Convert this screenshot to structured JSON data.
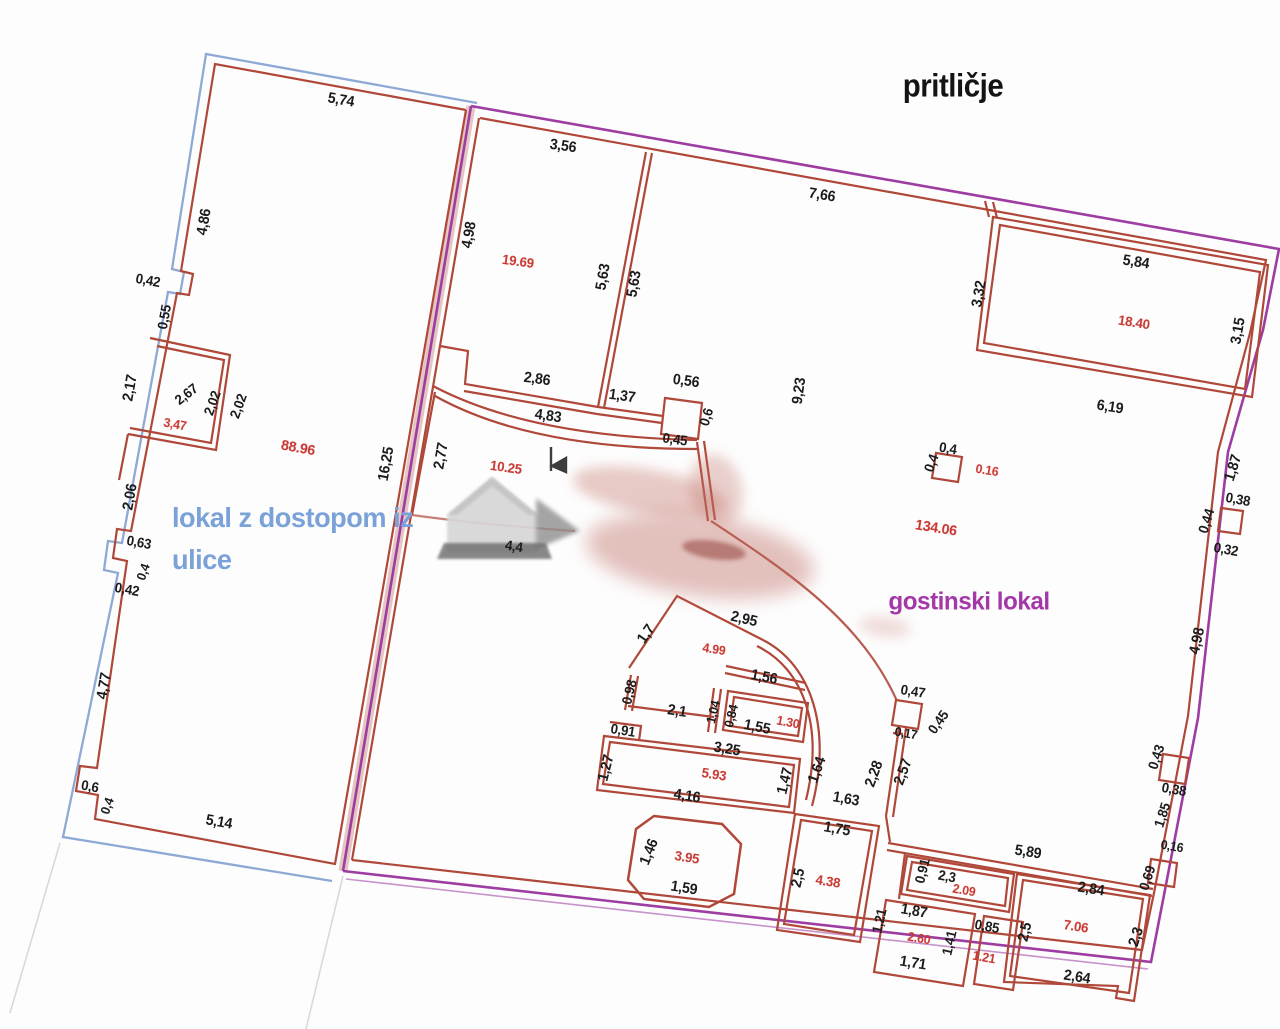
{
  "title": "pritličje",
  "units": {
    "left": {
      "name_line1": "lokal z dostopom iz",
      "name_line2": "ulice"
    },
    "right": {
      "name": "gostinski lokal"
    }
  },
  "colors": {
    "wall": "#b0483a",
    "area": "#c8352e",
    "dim": "#1c1c1c",
    "blue": "#8da9d4",
    "blueText": "#7aa2d8",
    "purple": "#9d3da2",
    "purpleText": "#a438a8"
  },
  "labels": [
    {
      "t": "5,74",
      "x": 341,
      "y": 100,
      "r": 10
    },
    {
      "t": "4,86",
      "x": 204,
      "y": 222,
      "r": -80
    },
    {
      "t": "0,42",
      "x": 148,
      "y": 280,
      "r": 10,
      "s": 14
    },
    {
      "t": "0,55",
      "x": 164,
      "y": 317,
      "r": -80,
      "s": 14
    },
    {
      "t": "2,17",
      "x": 130,
      "y": 388,
      "r": -80
    },
    {
      "t": "2,67",
      "x": 186,
      "y": 394,
      "r": -38,
      "s": 14
    },
    {
      "t": "2,02",
      "x": 212,
      "y": 403,
      "r": -70,
      "s": 14
    },
    {
      "t": "2,02",
      "x": 238,
      "y": 406,
      "r": -70,
      "s": 14
    },
    {
      "t": "2,06",
      "x": 130,
      "y": 497,
      "r": -80
    },
    {
      "t": "0,63",
      "x": 139,
      "y": 542,
      "r": 10,
      "s": 14
    },
    {
      "t": "0,4",
      "x": 143,
      "y": 572,
      "r": -70,
      "s": 13
    },
    {
      "t": "0,42",
      "x": 127,
      "y": 589,
      "r": 10,
      "s": 14
    },
    {
      "t": "4,77",
      "x": 104,
      "y": 686,
      "r": -80
    },
    {
      "t": "0,6",
      "x": 90,
      "y": 786,
      "r": 10,
      "s": 14
    },
    {
      "t": "0,4",
      "x": 107,
      "y": 806,
      "r": -70,
      "s": 13
    },
    {
      "t": "5,14",
      "x": 219,
      "y": 822,
      "r": 10
    },
    {
      "t": "16,25",
      "x": 386,
      "y": 464,
      "r": -80
    },
    {
      "t": "4,98",
      "x": 469,
      "y": 235,
      "r": -80
    },
    {
      "t": "3,56",
      "x": 563,
      "y": 146,
      "r": 8
    },
    {
      "t": "7,66",
      "x": 822,
      "y": 195,
      "r": 9
    },
    {
      "t": "5,63",
      "x": 603,
      "y": 277,
      "r": -80
    },
    {
      "t": "5,63",
      "x": 634,
      "y": 284,
      "r": -80
    },
    {
      "t": "2,86",
      "x": 537,
      "y": 379,
      "r": 8
    },
    {
      "t": "1,37",
      "x": 622,
      "y": 396,
      "r": 8
    },
    {
      "t": "0,56",
      "x": 686,
      "y": 381,
      "r": 8
    },
    {
      "t": "0,6",
      "x": 706,
      "y": 417,
      "r": -73,
      "s": 14
    },
    {
      "t": "0,45",
      "x": 675,
      "y": 439,
      "r": 8,
      "s": 14
    },
    {
      "t": "4,83",
      "x": 548,
      "y": 416,
      "r": 8
    },
    {
      "t": "2,77",
      "x": 441,
      "y": 456,
      "r": -80
    },
    {
      "t": "9,23",
      "x": 799,
      "y": 391,
      "r": -82
    },
    {
      "t": "4,4",
      "x": 514,
      "y": 546,
      "r": 9,
      "s": 14
    },
    {
      "t": "0,4",
      "x": 948,
      "y": 448,
      "r": 9,
      "s": 14
    },
    {
      "t": "0,4",
      "x": 931,
      "y": 463,
      "r": -70,
      "s": 14
    },
    {
      "t": "5,84",
      "x": 1136,
      "y": 262,
      "r": 9
    },
    {
      "t": "3,32",
      "x": 979,
      "y": 294,
      "r": -80
    },
    {
      "t": "3,15",
      "x": 1238,
      "y": 331,
      "r": -80
    },
    {
      "t": "6,19",
      "x": 1110,
      "y": 407,
      "r": 9
    },
    {
      "t": "1,87",
      "x": 1233,
      "y": 468,
      "r": -73
    },
    {
      "t": "0,38",
      "x": 1238,
      "y": 499,
      "r": 10,
      "s": 14
    },
    {
      "t": "0,44",
      "x": 1206,
      "y": 521,
      "r": -73,
      "s": 14
    },
    {
      "t": "0,32",
      "x": 1226,
      "y": 549,
      "r": 10,
      "s": 14
    },
    {
      "t": "4,98",
      "x": 1197,
      "y": 641,
      "r": -78
    },
    {
      "t": "1,7",
      "x": 646,
      "y": 634,
      "r": -55
    },
    {
      "t": "2,95",
      "x": 744,
      "y": 619,
      "r": 13
    },
    {
      "t": "1,56",
      "x": 764,
      "y": 677,
      "r": 11
    },
    {
      "t": "0,98",
      "x": 629,
      "y": 692,
      "r": -76,
      "s": 14
    },
    {
      "t": "2,1",
      "x": 677,
      "y": 711,
      "r": 9
    },
    {
      "t": "1,04",
      "x": 713,
      "y": 712,
      "r": -76,
      "s": 13
    },
    {
      "t": "0,84",
      "x": 731,
      "y": 716,
      "r": -76,
      "s": 13
    },
    {
      "t": "0,91",
      "x": 623,
      "y": 730,
      "r": 9,
      "s": 14
    },
    {
      "t": "1,55",
      "x": 757,
      "y": 727,
      "r": 11
    },
    {
      "t": "3,25",
      "x": 727,
      "y": 749,
      "r": 9
    },
    {
      "t": "1,27",
      "x": 606,
      "y": 768,
      "r": -76
    },
    {
      "t": "4,16",
      "x": 687,
      "y": 796,
      "r": 9
    },
    {
      "t": "1,47",
      "x": 785,
      "y": 781,
      "r": -76
    },
    {
      "t": "1,64",
      "x": 817,
      "y": 770,
      "r": -70
    },
    {
      "t": "1,63",
      "x": 846,
      "y": 799,
      "r": 10
    },
    {
      "t": "2,28",
      "x": 874,
      "y": 774,
      "r": -70
    },
    {
      "t": "2,57",
      "x": 903,
      "y": 772,
      "r": -70
    },
    {
      "t": "0,17",
      "x": 906,
      "y": 733,
      "r": 10,
      "s": 13
    },
    {
      "t": "0,45",
      "x": 938,
      "y": 722,
      "r": -55,
      "s": 14
    },
    {
      "t": "0,47",
      "x": 913,
      "y": 691,
      "r": 9,
      "s": 14
    },
    {
      "t": "1,46",
      "x": 649,
      "y": 852,
      "r": -68
    },
    {
      "t": "1,59",
      "x": 684,
      "y": 888,
      "r": 9
    },
    {
      "t": "2,5",
      "x": 798,
      "y": 878,
      "r": -77
    },
    {
      "t": "1,75",
      "x": 837,
      "y": 829,
      "r": 10
    },
    {
      "t": "0,91",
      "x": 922,
      "y": 871,
      "r": -76,
      "s": 14
    },
    {
      "t": "2,3",
      "x": 947,
      "y": 876,
      "r": 10,
      "s": 14
    },
    {
      "t": "5,89",
      "x": 1028,
      "y": 852,
      "r": 9
    },
    {
      "t": "2,84",
      "x": 1091,
      "y": 889,
      "r": 9
    },
    {
      "t": "0,69",
      "x": 1147,
      "y": 878,
      "r": -72,
      "s": 14
    },
    {
      "t": "0,16",
      "x": 1172,
      "y": 846,
      "r": 10,
      "s": 13
    },
    {
      "t": "1,85",
      "x": 1162,
      "y": 815,
      "r": -72,
      "s": 14
    },
    {
      "t": "0,38",
      "x": 1174,
      "y": 789,
      "r": 10,
      "s": 14
    },
    {
      "t": "0,43",
      "x": 1156,
      "y": 757,
      "r": -72,
      "s": 14
    },
    {
      "t": "1,21",
      "x": 879,
      "y": 921,
      "r": -77,
      "s": 14
    },
    {
      "t": "1,87",
      "x": 914,
      "y": 911,
      "r": 10
    },
    {
      "t": "1,71",
      "x": 913,
      "y": 963,
      "r": 9
    },
    {
      "t": "1,41",
      "x": 949,
      "y": 943,
      "r": -77,
      "s": 14
    },
    {
      "t": "0,85",
      "x": 987,
      "y": 926,
      "r": 10,
      "s": 14
    },
    {
      "t": "2,5",
      "x": 1025,
      "y": 932,
      "r": -77
    },
    {
      "t": "2,3",
      "x": 1136,
      "y": 937,
      "r": -72
    },
    {
      "t": "2,64",
      "x": 1077,
      "y": 977,
      "r": 9
    },
    {
      "t": "3,47",
      "x": 175,
      "y": 424,
      "r": 10,
      "c": "a",
      "s": 13
    },
    {
      "t": "88.96",
      "x": 298,
      "y": 448,
      "r": 10,
      "c": "a"
    },
    {
      "t": "19.69",
      "x": 518,
      "y": 261,
      "r": 8,
      "c": "a",
      "s": 14
    },
    {
      "t": "10.25",
      "x": 506,
      "y": 467,
      "r": 8,
      "c": "a",
      "s": 14
    },
    {
      "t": "0.16",
      "x": 987,
      "y": 470,
      "r": 9,
      "c": "a",
      "s": 13
    },
    {
      "t": "134.06",
      "x": 936,
      "y": 528,
      "r": 9,
      "c": "a"
    },
    {
      "t": "18.40",
      "x": 1134,
      "y": 322,
      "r": 9,
      "c": "a",
      "s": 14
    },
    {
      "t": "4.99",
      "x": 714,
      "y": 649,
      "r": 9,
      "c": "a",
      "s": 13
    },
    {
      "t": "1.30",
      "x": 788,
      "y": 722,
      "r": 11,
      "c": "a",
      "s": 13
    },
    {
      "t": "5.93",
      "x": 714,
      "y": 774,
      "r": 9,
      "c": "a",
      "s": 14
    },
    {
      "t": "3.95",
      "x": 687,
      "y": 857,
      "r": 9,
      "c": "a",
      "s": 14
    },
    {
      "t": "4.38",
      "x": 828,
      "y": 881,
      "r": 9,
      "c": "a",
      "s": 14
    },
    {
      "t": "2.09",
      "x": 964,
      "y": 890,
      "r": 10,
      "c": "a",
      "s": 13
    },
    {
      "t": "2.60",
      "x": 919,
      "y": 938,
      "r": 10,
      "c": "a",
      "s": 13
    },
    {
      "t": "1.21",
      "x": 984,
      "y": 957,
      "r": 10,
      "c": "a",
      "s": 13
    },
    {
      "t": "7.06",
      "x": 1076,
      "y": 926,
      "r": 9,
      "c": "a",
      "s": 14
    }
  ]
}
